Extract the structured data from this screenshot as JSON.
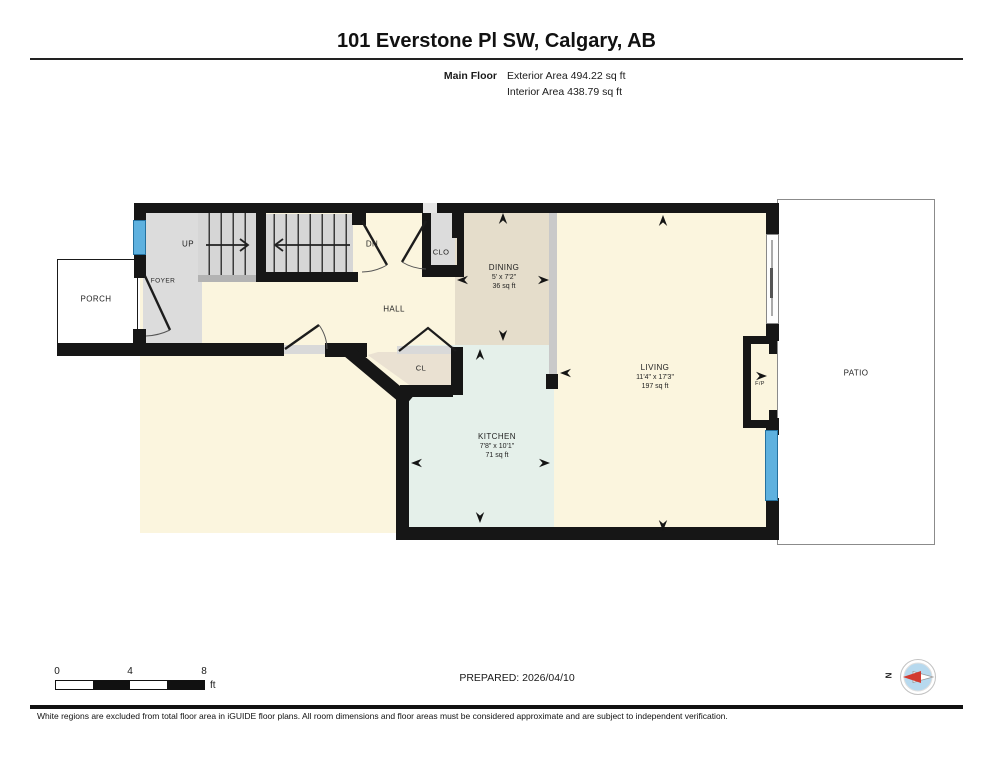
{
  "header": {
    "title": "101 Everstone Pl SW, Calgary, AB",
    "floor_label": "Main Floor",
    "exterior_area": "Exterior Area 494.22 sq ft",
    "interior_area": "Interior Area 438.79 sq ft"
  },
  "rooms": {
    "porch": "PORCH",
    "foyer": "FOYER",
    "up": "UP",
    "dn": "DN",
    "clo": "CLO",
    "hall": "HALL",
    "cl": "CL",
    "dining": {
      "name": "DINING",
      "dims": "5' x 7'2\"",
      "area": "36 sq ft"
    },
    "kitchen": {
      "name": "KITCHEN",
      "dims": "7'8\" x 10'1\"",
      "area": "71 sq ft"
    },
    "living": {
      "name": "LIVING",
      "dims": "11'4\" x 17'3\"",
      "area": "197 sq ft"
    },
    "fireplace": "F/P",
    "patio": "PATIO"
  },
  "scale_bar": {
    "tick_0": "0",
    "tick_4": "4",
    "tick_8": "8",
    "unit": "ft"
  },
  "footer": {
    "prepared": "PREPARED: 2026/04/10",
    "compass_north": "N",
    "disclaimer": "White regions are excluded from total floor area in iGUIDE floor plans. All room dimensions and floor areas must be considered approximate and are subject to independent verification."
  },
  "colors": {
    "wall": "#161616",
    "floor_cream": "#FBF5DE",
    "floor_gray": "#DCDCDC",
    "floor_dining": "#E5DDCB",
    "floor_kitchen": "#E5F0EA",
    "floor_closet": "#EAE1D2",
    "window_blue": "#5EB1DF",
    "compass_fill": "#B7D9EE",
    "compass_needle_red": "#D23B30"
  }
}
